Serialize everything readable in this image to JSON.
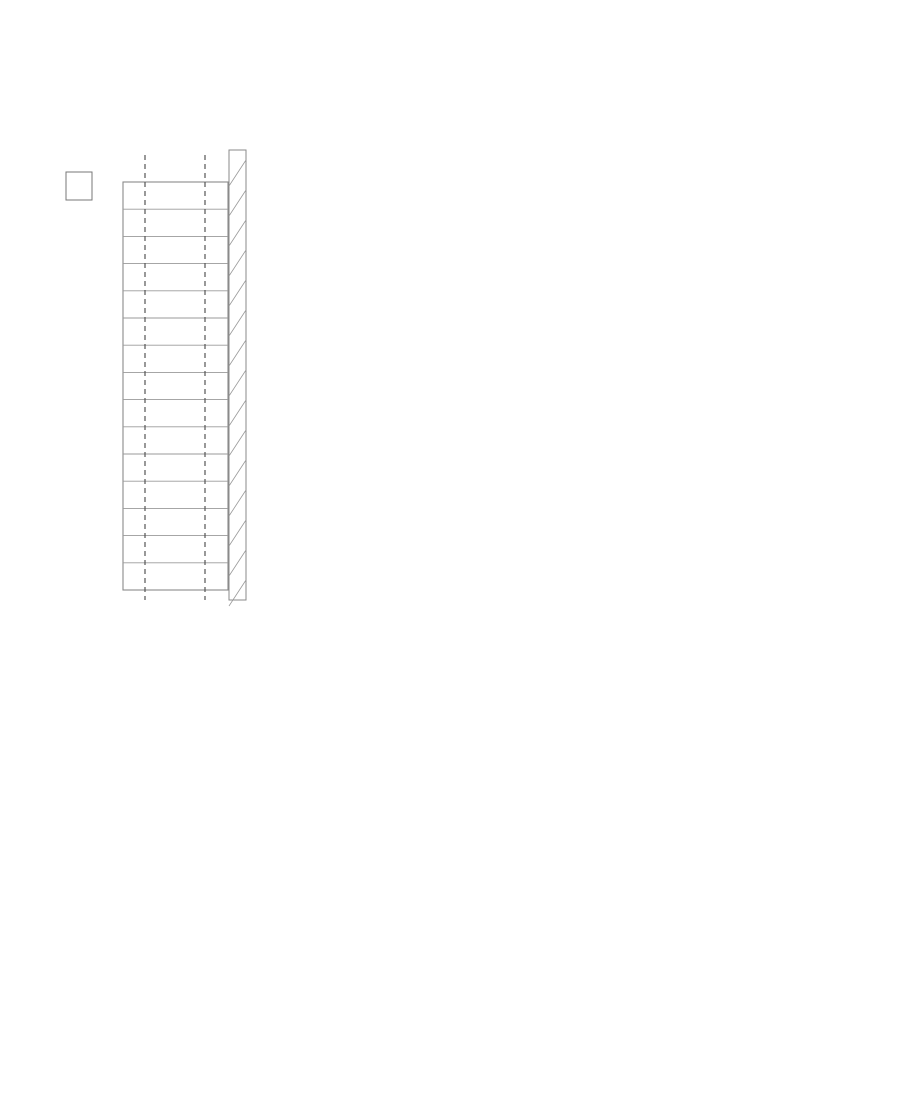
{
  "drawing": {
    "type": "architectural-floor-plan",
    "rooms": [
      {
        "number": "1011",
        "name": "TREPIKODA",
        "area": "12,0 m²"
      },
      {
        "number": "1012",
        "name": "TREPIKODA",
        "area": "14,5 m²"
      },
      {
        "number": "1013",
        "name": "RAAMATUKOGU HOIDLA",
        "area": "58,2 m²"
      },
      {
        "number": "1014",
        "name": "TEHN.",
        "area": "4,8 m²"
      },
      {
        "number": "1002-C",
        "name": "LIFT-3",
        "area": "5,0 m²"
      },
      {
        "number": "1015",
        "name": "LUGEMISSAAL",
        "area": "292,4 m²",
        "occupancy": "50"
      }
    ]
  },
  "colors": {
    "blue": "#1e22dd",
    "red": "#e02a20",
    "redline": "#d5231b",
    "dark": "#333333",
    "wall": "#232323",
    "grid": "#4a4a4a",
    "furn": "#6a6a6a",
    "bubble_text": "#2b50b5"
  },
  "grid_bubbles": [
    {
      "label": "3",
      "x": 808,
      "y": 478,
      "r": 22
    },
    {
      "label": "4",
      "x": 719,
      "y": 641,
      "r": 21
    },
    {
      "label": "5",
      "x": 634,
      "y": 802,
      "r": 21
    },
    {
      "label": "7",
      "x": 383,
      "y": 1110,
      "r": 21
    }
  ],
  "labels": [
    {
      "t": "1011",
      "x": 28,
      "y": 24,
      "s": 13,
      "u": 1
    },
    {
      "t": "TREPIKODA",
      "x": 37,
      "y": 42
    },
    {
      "t": "12,0 m²",
      "x": 26,
      "y": 58
    },
    {
      "t": "1012",
      "x": 22,
      "y": 97,
      "s": 13,
      "u": 1
    },
    {
      "t": "TREPIKODA",
      "x": 37,
      "y": 114
    },
    {
      "t": "14,5 m²",
      "x": 27,
      "y": 129
    },
    {
      "t": "TP-11-2",
      "x": 152,
      "y": 68
    },
    {
      "t": "TP-11",
      "x": 157,
      "y": 89
    },
    {
      "t": "TP-15",
      "x": 155,
      "y": 127
    },
    {
      "t": "TP-12",
      "x": 216,
      "y": 55,
      "rot": -90
    },
    {
      "t": "M-33",
      "x": 273,
      "y": 165,
      "rot": -90
    },
    {
      "t": "1013",
      "x": 79,
      "y": 208,
      "s": 13,
      "u": 1
    },
    {
      "t": "RAAMATUKOGU HOIDLA",
      "x": 128,
      "y": 226
    },
    {
      "t": "58,2 m²",
      "x": 81,
      "y": 240
    },
    {
      "t": "M-65",
      "x": 114,
      "y": 264
    },
    {
      "t": "1014",
      "x": 42,
      "y": 316,
      "s": 13,
      "u": 1
    },
    {
      "t": "TEHN.",
      "x": 40,
      "y": 332
    },
    {
      "t": "4,8 m²",
      "x": 39,
      "y": 347
    },
    {
      "t": "1002-C",
      "x": 41,
      "y": 425,
      "s": 13,
      "u": 1
    },
    {
      "t": "LIFT-3",
      "x": 33,
      "y": 441
    },
    {
      "t": "5,0 m²",
      "x": 31,
      "y": 456
    },
    {
      "t": "1015",
      "x": 310,
      "y": 583,
      "s": 13,
      "u": 1
    },
    {
      "t": "LUGEMISSAAL",
      "x": 333,
      "y": 601
    },
    {
      "t": "292,4 m²",
      "x": 317,
      "y": 616
    },
    {
      "t": "50",
      "x": 299,
      "y": 631
    },
    {
      "t": "EM-16",
      "x": 434,
      "y": 31
    },
    {
      "t": "EM-16",
      "x": 434,
      "y": 49
    },
    {
      "t": "EM-16",
      "x": 434,
      "y": 67
    },
    {
      "t": "EM-16",
      "x": 310,
      "y": 93
    },
    {
      "t": "EM-16",
      "x": 310,
      "y": 112
    },
    {
      "t": "EM-16",
      "x": 310,
      "y": 131
    },
    {
      "t": "EM-26.2",
      "x": 362,
      "y": 111
    },
    {
      "t": "EM-26.2",
      "x": 445,
      "y": 114
    },
    {
      "t": "vt joonis SA-6.53",
      "x": 412,
      "y": 131
    },
    {
      "t": "EM-26.2",
      "x": 557,
      "y": 115
    },
    {
      "t": "EM-26.2",
      "x": 626,
      "y": 115
    },
    {
      "t": "vt joonis SA-6.53",
      "x": 608,
      "y": 133
    },
    {
      "t": "EM-11",
      "x": 480,
      "y": 17
    },
    {
      "t": "EM-11",
      "x": 527,
      "y": 18
    },
    {
      "t": "EM-11",
      "x": 574,
      "y": 18
    },
    {
      "t": "EM-11",
      "x": 620,
      "y": 16
    },
    {
      "t": "EM-11",
      "x": 658,
      "y": 20
    },
    {
      "t": "EM-11",
      "x": 732,
      "y": 17
    },
    {
      "t": "EM-11",
      "x": 776,
      "y": 15
    },
    {
      "t": "vt joonis SA-6.11",
      "x": 529,
      "y": 58
    },
    {
      "t": "vt joonis SA-6.11",
      "x": 760,
      "y": 58
    },
    {
      "t": "M-31",
      "x": 822,
      "y": 23
    },
    {
      "t": "M-32",
      "x": 858,
      "y": 27
    },
    {
      "t": "SI-02F3",
      "x": 479,
      "y": 10,
      "c": "r"
    },
    {
      "t": "SI-02J4",
      "x": 544,
      "y": 10,
      "c": "r"
    },
    {
      "t": "SI-02E3",
      "x": 607,
      "y": 10,
      "c": "r"
    },
    {
      "t": "SI-02M3",
      "x": 664,
      "y": 10,
      "c": "r"
    },
    {
      "t": "SI-02M3",
      "x": 737,
      "y": 12,
      "c": "r"
    },
    {
      "t": "SI-02F3",
      "x": 788,
      "y": 12,
      "c": "r"
    },
    {
      "t": "SI-02E3",
      "x": 846,
      "y": 11,
      "c": "r"
    },
    {
      "t": "SI-02C",
      "x": 899,
      "y": 12,
      "c": "r"
    },
    {
      "t": "SI-02.2",
      "x": 429,
      "y": 38,
      "c": "r",
      "rot": 90
    },
    {
      "t": "vt joonis SA-6.12",
      "x": 500,
      "y": 170
    },
    {
      "t": "EM-12",
      "x": 400,
      "y": 183
    },
    {
      "t": "EM-12",
      "x": 362,
      "y": 202
    },
    {
      "t": "EM-12",
      "x": 453,
      "y": 202
    },
    {
      "t": "EM-12",
      "x": 495,
      "y": 187
    },
    {
      "t": "EM-12",
      "x": 541,
      "y": 202
    },
    {
      "t": "EM-12",
      "x": 580,
      "y": 184
    },
    {
      "t": "EM-12",
      "x": 623,
      "y": 202
    },
    {
      "t": "vt joonis SA-6.12",
      "x": 500,
      "y": 252
    },
    {
      "t": "EM-12",
      "x": 415,
      "y": 270
    },
    {
      "t": "EM-12",
      "x": 490,
      "y": 268
    },
    {
      "t": "EM-12",
      "x": 365,
      "y": 285
    },
    {
      "t": "EM-12",
      "x": 455,
      "y": 287
    },
    {
      "t": "EM-12",
      "x": 548,
      "y": 287
    },
    {
      "t": "36xM-24",
      "x": 427,
      "y": 323
    },
    {
      "t": "EM-26.2",
      "x": 356,
      "y": 352
    },
    {
      "t": "EM-26.3",
      "x": 466,
      "y": 352
    },
    {
      "t": "vt joonis SA-6.53",
      "x": 363,
      "y": 372
    },
    {
      "t": "vt joonis SA-6.54",
      "x": 470,
      "y": 372
    },
    {
      "t": "EM-28.2",
      "x": 331,
      "y": 443,
      "rot": -90
    },
    {
      "t": "vt joonis SA-6.53",
      "x": 351,
      "y": 442,
      "rot": -90
    },
    {
      "t": "EM-26.3",
      "x": 399,
      "y": 443,
      "rot": -90
    },
    {
      "t": "vt joonis SA-6.54",
      "x": 421,
      "y": 445,
      "rot": -90
    },
    {
      "t": "M-62",
      "x": 113,
      "y": 411
    },
    {
      "t": "M-62",
      "x": 300,
      "y": 448
    },
    {
      "t": "M-62",
      "x": 300,
      "y": 506
    },
    {
      "t": "EM-26.4",
      "x": 240,
      "y": 185,
      "rot": -90
    },
    {
      "t": "EM-26.4",
      "x": 240,
      "y": 238,
      "rot": -90
    },
    {
      "t": "EM-26.4",
      "x": 240,
      "y": 291,
      "rot": -90
    },
    {
      "t": "EM-26.4",
      "x": 240,
      "y": 344,
      "rot": -90
    },
    {
      "t": "EM-26.4",
      "x": 240,
      "y": 397,
      "rot": -90
    },
    {
      "t": "EM-26.4",
      "x": 240,
      "y": 450,
      "rot": -90
    },
    {
      "t": "EM-26.4",
      "x": 240,
      "y": 503,
      "rot": -90
    },
    {
      "t": "EM-26.4",
      "x": 240,
      "y": 556,
      "rot": -90
    },
    {
      "t": "vt joonis SA-6.55",
      "x": 256,
      "y": 350,
      "rot": -90
    },
    {
      "t": "vt joonis SA-6.55",
      "x": 256,
      "y": 540,
      "rot": -90
    },
    {
      "t": "A",
      "x": 7,
      "y": 514,
      "c": "d",
      "s": 16
    },
    {
      "t": "B",
      "x": 4,
      "y": 597,
      "c": "d",
      "s": 16
    },
    {
      "t": "16x M-54",
      "x": 96,
      "y": 537
    },
    {
      "t": "vt joonis SA-6.49",
      "x": 66,
      "y": 553
    },
    {
      "t": "EM-33 ST-11",
      "x": 54,
      "y": 568
    },
    {
      "t": "EM-16",
      "x": 108,
      "y": 573
    },
    {
      "t": "EM-26.4",
      "x": 129,
      "y": 597
    },
    {
      "t": "EM-26.4",
      "x": 203,
      "y": 597
    },
    {
      "t": "vt joonis SA-6.55",
      "x": 146,
      "y": 612
    },
    {
      "t": "M-11T",
      "x": 112,
      "y": 636
    },
    {
      "t": "M-11T",
      "x": 174,
      "y": 636
    },
    {
      "t": "M-33",
      "x": 253,
      "y": 641
    },
    {
      "t": "EM-10",
      "x": 140,
      "y": 659
    },
    {
      "t": "vt joonis SA-6.10",
      "x": 155,
      "y": 674
    },
    {
      "t": "EM-26.4",
      "x": 6,
      "y": 655,
      "rot": -90
    },
    {
      "t": "M-27",
      "x": 382,
      "y": 640,
      "rot": -55
    },
    {
      "t": "M-30",
      "x": 361,
      "y": 668
    },
    {
      "t": "M-27",
      "x": 333,
      "y": 698,
      "rot": -55
    },
    {
      "t": "M-31",
      "x": 291,
      "y": 738
    },
    {
      "t": "M-32",
      "x": 326,
      "y": 744
    },
    {
      "t": "M-47",
      "x": 190,
      "y": 735
    },
    {
      "t": "EM-26.1",
      "x": 227,
      "y": 775
    },
    {
      "t": "vt joonis SA-6.42",
      "x": 236,
      "y": 793
    },
    {
      "t": "SI-02",
      "x": 263,
      "y": 812,
      "c": "r"
    },
    {
      "t": "M-33",
      "x": 203,
      "y": 857,
      "rot": -55
    },
    {
      "t": "EM-11",
      "x": 886,
      "y": 46
    },
    {
      "t": "EM-11",
      "x": 871,
      "y": 72
    },
    {
      "t": "EM-11",
      "x": 843,
      "y": 108
    },
    {
      "t": "EM-11",
      "x": 785,
      "y": 163
    },
    {
      "t": "EM-11",
      "x": 757,
      "y": 195
    },
    {
      "t": "EM-11",
      "x": 729,
      "y": 230
    },
    {
      "t": "EM-11",
      "x": 701,
      "y": 265
    },
    {
      "t": "EM-11",
      "x": 656,
      "y": 318
    },
    {
      "t": "EM-11",
      "x": 627,
      "y": 352
    },
    {
      "t": "EM-11",
      "x": 598,
      "y": 385
    },
    {
      "t": "EM-11",
      "x": 570,
      "y": 420
    },
    {
      "t": "EM-11",
      "x": 558,
      "y": 446
    },
    {
      "t": "EM-11",
      "x": 498,
      "y": 523
    },
    {
      "t": "EM-11",
      "x": 462,
      "y": 553
    },
    {
      "t": "EM-11",
      "x": 183,
      "y": 899
    },
    {
      "t": "EM-11",
      "x": 150,
      "y": 933
    },
    {
      "t": "EM-11",
      "x": 134,
      "y": 968
    },
    {
      "t": "EM-11",
      "x": 102,
      "y": 1005
    },
    {
      "t": "EM-26.2",
      "x": 789,
      "y": 108,
      "rot": -50
    },
    {
      "t": "EM-26.2",
      "x": 662,
      "y": 262,
      "rot": -50
    },
    {
      "t": "EM-26.2",
      "x": 505,
      "y": 450,
      "rot": -50
    },
    {
      "t": "vt joonis SA-6.11",
      "x": 713,
      "y": 186,
      "rot": -50
    },
    {
      "t": "vt joonis SA-6.11",
      "x": 600,
      "y": 355,
      "rot": -50
    },
    {
      "t": "vt joonis SA-6.11",
      "x": 148,
      "y": 908,
      "rot": -50
    },
    {
      "t": "SI-02D.2",
      "x": 864,
      "y": 117,
      "c": "r",
      "rot": -50,
      "s": 9
    },
    {
      "t": "SI-02M.3",
      "x": 819,
      "y": 171,
      "c": "r",
      "rot": -50,
      "s": 9
    },
    {
      "t": "SI-02E.3",
      "x": 774,
      "y": 225,
      "c": "r",
      "rot": -50,
      "s": 9
    },
    {
      "t": "SI-02B.3",
      "x": 730,
      "y": 279,
      "c": "r",
      "rot": -50,
      "s": 9
    },
    {
      "t": "SI-02M.3",
      "x": 685,
      "y": 333,
      "c": "r",
      "rot": -50,
      "s": 9
    },
    {
      "t": "SI-02E.3",
      "x": 640,
      "y": 387,
      "c": "r",
      "rot": -50,
      "s": 9
    },
    {
      "t": "SI-02B.4",
      "x": 595,
      "y": 440,
      "c": "r",
      "rot": -50,
      "s": 9
    },
    {
      "t": "SI-02E.3",
      "x": 551,
      "y": 494,
      "c": "r",
      "rot": -50,
      "s": 9
    },
    {
      "t": "SI-02J.4",
      "x": 506,
      "y": 548,
      "c": "r",
      "rot": -50,
      "s": 9
    },
    {
      "t": "SI-02N.3",
      "x": 461,
      "y": 602,
      "c": "r",
      "rot": -50,
      "s": 9
    },
    {
      "t": "SI-02M.3",
      "x": 416,
      "y": 656,
      "c": "r",
      "rot": -50,
      "s": 9
    },
    {
      "t": "SI-02C.3",
      "x": 372,
      "y": 709,
      "c": "r",
      "rot": -50,
      "s": 9
    },
    {
      "t": "SI-02B.3",
      "x": 327,
      "y": 763,
      "c": "r",
      "rot": -50,
      "s": 9
    },
    {
      "t": "SI-02B.4",
      "x": 282,
      "y": 817,
      "c": "r",
      "rot": -50,
      "s": 9
    },
    {
      "t": "SI-02D.2",
      "x": 237,
      "y": 871,
      "c": "r",
      "rot": -50,
      "s": 9
    },
    {
      "t": "SI-02B.4",
      "x": 193,
      "y": 925,
      "c": "r",
      "rot": -50,
      "s": 9
    },
    {
      "t": "SI-02I.4",
      "x": 148,
      "y": 978,
      "c": "r",
      "rot": -50,
      "s": 9
    },
    {
      "t": "SI-02D.2",
      "x": 103,
      "y": 1032,
      "c": "r",
      "rot": -50,
      "s": 9
    },
    {
      "t": "SI-02I.4",
      "x": 65,
      "y": 1078,
      "c": "r",
      "rot": -50,
      "s": 9
    },
    {
      "t": "EM-28.3",
      "x": 54,
      "y": 799,
      "rot": -90
    },
    {
      "t": "vt joonis SA-6.54",
      "x": 70,
      "y": 800,
      "rot": -90
    },
    {
      "t": "EM-26.8",
      "x": 118,
      "y": 822,
      "rot": -90
    },
    {
      "t": "vt joonis SA-6.54",
      "x": 141,
      "y": 808,
      "rot": -90
    },
    {
      "t": "EM-28.2",
      "x": 54,
      "y": 928,
      "rot": -90
    },
    {
      "t": "EM-26.4",
      "x": 9,
      "y": 1040,
      "rot": -90
    },
    {
      "t": "M-30",
      "x": 62,
      "y": 1054
    },
    {
      "t": "M-29",
      "x": 37,
      "y": 1082
    }
  ]
}
